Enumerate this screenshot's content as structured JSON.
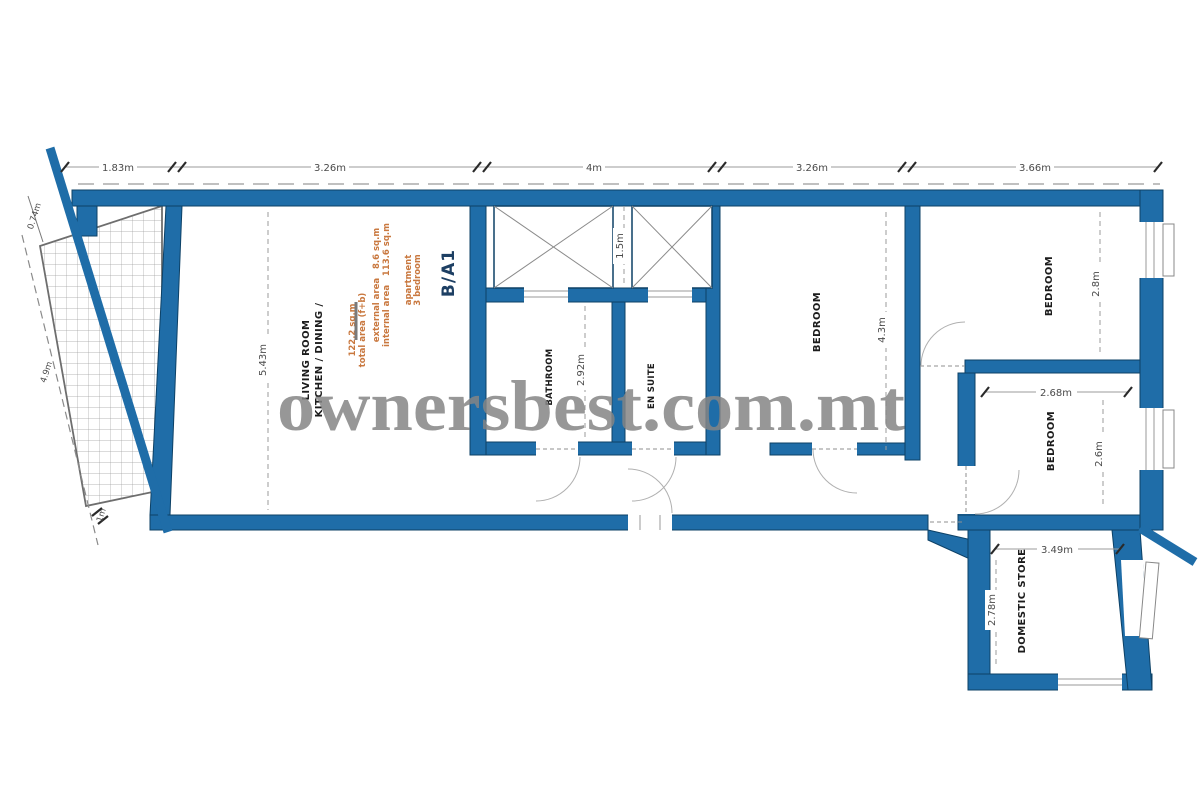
{
  "watermark": {
    "text": "ownersbest.com.mt"
  },
  "title_block": {
    "unit": "B/A1",
    "type_line1": "3 bedroom",
    "type_line2": "apartment",
    "internal": "internal area   113.6 sq.m",
    "external": "external area   8.6 sq.m",
    "total_label": "total area (f+b)",
    "total_value": "122.2 sq.m"
  },
  "rooms": {
    "kitchen_line1": "KITCHEN / DINING /",
    "kitchen_line2": "LIVING ROOM",
    "bathroom": "BATHROOM",
    "ensuite": "EN SUITE",
    "bedroom_mid": "BEDROOM",
    "bedroom_top_right": "BEDROOM",
    "bedroom_bottom_right": "BEDROOM",
    "store": "DOMESTIC STORE"
  },
  "dims": {
    "top": [
      "1.83m",
      "3.26m",
      "4m",
      "3.26m",
      "3.66m"
    ],
    "kitchen_depth": "5.43m",
    "shaft_width": "1.5m",
    "bathroom_depth": "2.92m",
    "bedroom_mid_depth": "4.3m",
    "bedroom_top_right_depth": "2.8m",
    "bedroom_bottom_right_width": "2.68m",
    "bedroom_bottom_right_depth": "2.6m",
    "store_width": "3.49m",
    "store_depth": "2.78m",
    "terrace_top": "0.74m",
    "terrace_side": "4.9m",
    "terrace_bottom": "1m"
  },
  "colors": {
    "wall_fill": "#1f6da8",
    "wall_border": "#0d4166",
    "watermark_gray": "#858585",
    "info_orange": "#c9783f",
    "title_navy": "#1d3f63",
    "dim_gray": "#4a4a4a",
    "hatch_gray": "#a0a0a0"
  }
}
